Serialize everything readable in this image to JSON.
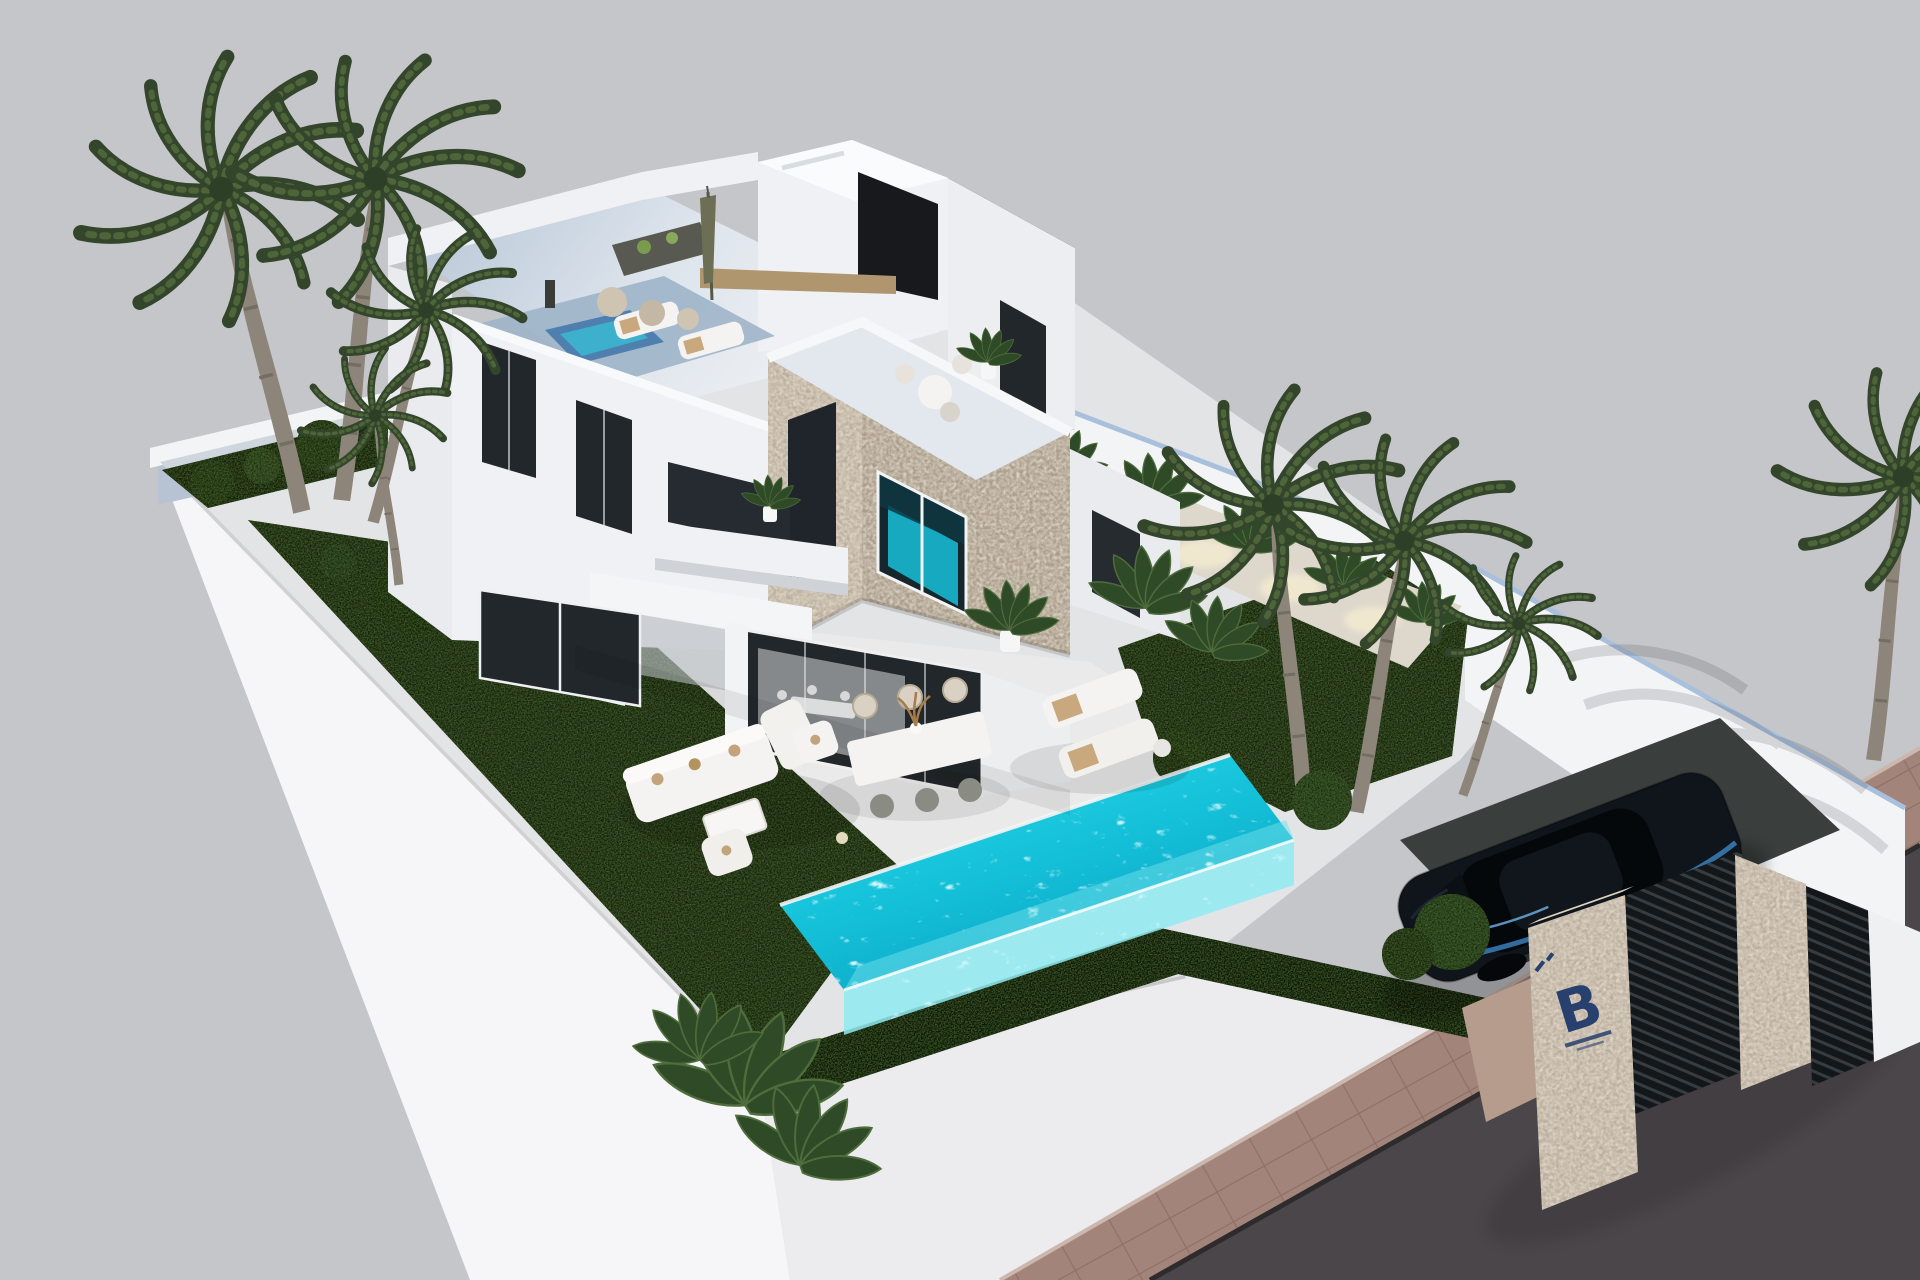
{
  "scene": {
    "title": "Aerial 3D render of a modern two-storey villa with rooftop terraces, landscaped garden, private pool, carport and branded entrance pillar",
    "sky_color": "#c5c6ca"
  },
  "branding": {
    "gate_logo_letter": "B",
    "gate_logo_color": "#27406d"
  },
  "palette": {
    "sky": "#c5c6ca",
    "podium_light": "#f6f6f8",
    "podium_front": "#ececef",
    "plot_floor": "#e3e4e6",
    "terrace": "#eaeaeb",
    "wall_white": "#f3f4f6",
    "wall_cap": "#a9c0dc",
    "roof_floor": "#b7c6d7",
    "house_white": "#f0f1f4",
    "house_side": "#e9ebee",
    "glass_dark": "#22272c",
    "stone": "#c9bcab",
    "stone_dark": "#b3a693",
    "grass": "#2b3a22",
    "hedge": "#1d2815",
    "pool_top": "#24d5e6",
    "pool_deep": "#0aa6c5",
    "pool_glass": "#8feaf1",
    "plunge_pool": "#4f7fae",
    "road": "#4b4649",
    "sidewalk": "#a3847a",
    "gate_dark": "#14171a",
    "car_body": "#0f151b",
    "car_accent": "#3f8fd0",
    "umbrella": "#6c6f53",
    "wood": "#b0966f",
    "furniture_white": "#f4f3f1",
    "cushion_tan": "#c2a37c",
    "passage_floor": "#ded8cc",
    "light_warm": "#f7ecd0",
    "plant_green": "#2f4a27"
  },
  "objects": {
    "villa": "Two-storey white villa with stone-clad cube volume",
    "rooftop_terrace": "Roof terrace with lounge set, wooden table, poufs and closed parasol",
    "middle_terrace": "First-floor terrace with plunge pool and two sun loungers",
    "stone_cube": "Stone-clad cube with picture window reflecting the pool and rooftop seating",
    "main_pool": "Turquoise pool with glass overflow edge",
    "garden": "Dark lawns with palm trees, banana plants and clipped hedge",
    "outdoor_dining": "White outdoor dining table with six chairs",
    "lounge_set": "White garden lounge sofa set with coffee table",
    "sun_loungers": "Pair of white sun loungers with tan towels",
    "carport": "Open carport with dark blue sedan",
    "entrance": "Street entrance with stone pillars, slatted gates and logo sign",
    "street": "Paved sidewalk and asphalt road"
  }
}
